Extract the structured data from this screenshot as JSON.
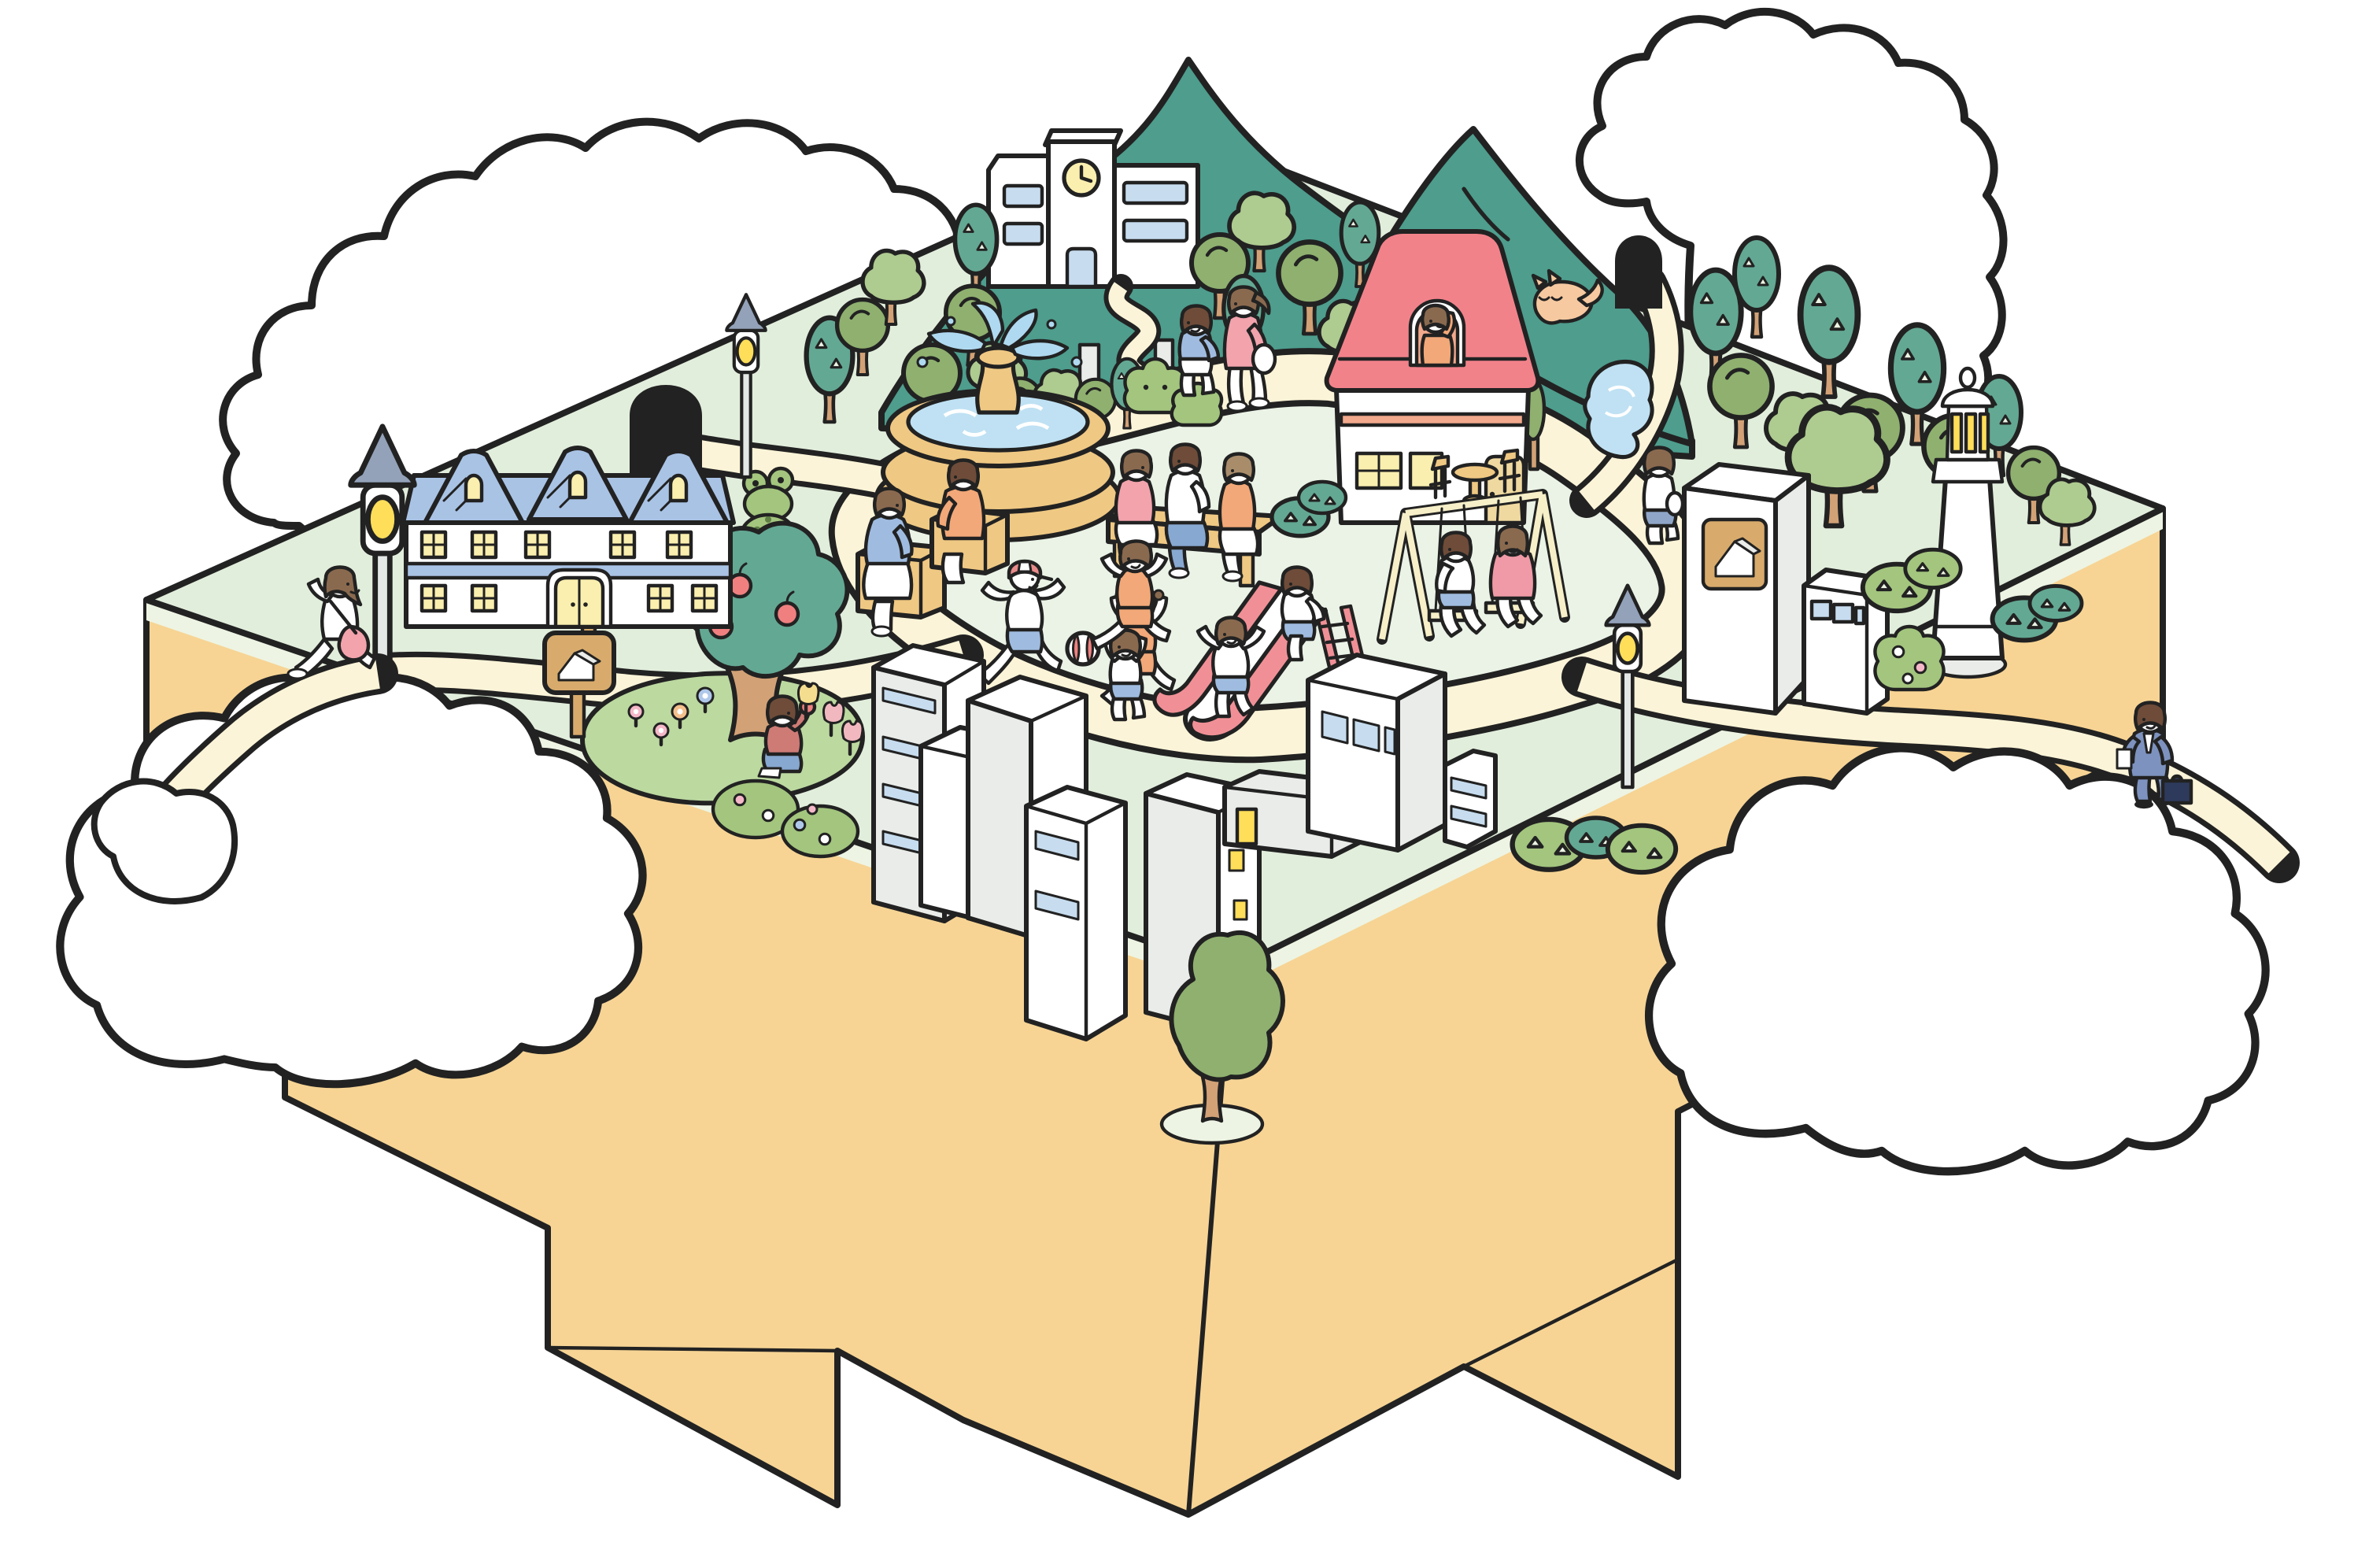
{
  "title": "Cartoon isometric floating-island town with park, houses and playing children",
  "palette": {
    "ink": "#222222",
    "cloud": "#FFFFFF",
    "base": "#F7D494",
    "grass": "#E2EEDC",
    "plaza": "#EAF3E6",
    "band": "#EDF4E3",
    "path": "#FCF4D8",
    "mountain": "#4E9D8D",
    "treeGreen": "#8FB06F",
    "treeLight": "#AECB90",
    "treeTeal": "#63A893",
    "trunk": "#D2A176",
    "bush": "#A3C57E",
    "mound": "#BCD9A0",
    "roofBlue": "#A9C3E5",
    "roofRed": "#F2828A",
    "wall": "#FFFFFF",
    "sideGray": "#E9ECE9",
    "windowYellow": "#FAEFAE",
    "windowBlue": "#C7DDEF",
    "salmon": "#F2A98C",
    "doorTan": "#EFD9A0",
    "fountainTan": "#EFC883",
    "water": "#BFE1F3",
    "spray": "#AFD9F0",
    "slidePink": "#F09096",
    "swingCream": "#F6EFC8",
    "lampPole": "#E4E8E6",
    "lampCap": "#93A2B9",
    "bulbYellow": "#FFDE59",
    "signTan": "#D8AB6C",
    "suitBlue": "#7D92BE",
    "jeansBlue": "#87A8D0",
    "clothPink": "#F2A3AC",
    "clothOrange": "#F2A878",
    "clothBlue": "#9FBCE0",
    "skirtBlue": "#8FA6C9",
    "dressPink": "#EF9AA6",
    "capRed": "#E98B8B",
    "hairDark": "#6E4C39",
    "hairMid": "#8A6A4F",
    "hairLight": "#A98D6B",
    "catOrange": "#F6C9A0",
    "appleRed": "#F08080",
    "flowerPink": "#F4B8C8",
    "flowerBlue": "#AFC8EA",
    "flowerOrange": "#F5C08C",
    "tulipYellow": "#F5DD8F",
    "tulipPink": "#F2B8C0",
    "shirtRust": "#CE7B76"
  },
  "scene": {
    "island": {
      "shape": "isometric block with stepped puzzle-like tan base",
      "surface": "pale green park with looping cream walking path",
      "tunnel_count": 2
    },
    "clouds": [
      {
        "id": "cloud-top-left"
      },
      {
        "id": "cloud-top-right"
      },
      {
        "id": "cloud-left"
      },
      {
        "id": "cloud-bottom-right"
      }
    ],
    "landmarks": [
      {
        "id": "mountain",
        "color_key": "mountain",
        "peaks": 2
      },
      {
        "id": "school",
        "has_clock_tower": true,
        "clock_face": "yellow",
        "window_color_key": "windowBlue"
      },
      {
        "id": "fountain",
        "tiers": 2,
        "water": true,
        "spray": true
      },
      {
        "id": "apartment-house",
        "roof_color_key": "roofBlue",
        "gables": 3,
        "lit_windows": true
      },
      {
        "id": "red-roof-house",
        "roof_color_key": "roofRed",
        "girl_in_attic_window": true
      },
      {
        "id": "lighthouse",
        "lit_lantern_windows": 3
      },
      {
        "id": "store-building",
        "sign_icon": "house-pictogram"
      },
      {
        "id": "small-office-building",
        "window_strip": 3
      },
      {
        "id": "city-buildings",
        "count": 8,
        "window_colors": [
          "windowBlue",
          "windowYellow"
        ]
      },
      {
        "id": "playground-slide",
        "color_key": "slidePink"
      },
      {
        "id": "swing-set",
        "seats": 2,
        "frame_color_key": "swingCream"
      },
      {
        "id": "apple-tree",
        "apples": 3
      },
      {
        "id": "frog-topiary"
      },
      {
        "id": "flower-garden",
        "flowers": [
          "pink",
          "blue",
          "orange",
          "tulips"
        ]
      },
      {
        "id": "pond"
      },
      {
        "id": "notice-sign",
        "icon": "house-pictogram"
      },
      {
        "id": "cafe-table-set",
        "chairs": 2
      },
      {
        "id": "bench-blocks",
        "count": 3
      },
      {
        "id": "street-lamps",
        "count": 3,
        "bulb_color_key": "bulbYellow"
      },
      {
        "id": "tunnels",
        "count": 2,
        "color": "black"
      }
    ],
    "people": [
      {
        "id": "mother-walking",
        "top": "clothPink",
        "bottom": "white",
        "bag": "white"
      },
      {
        "id": "child-walking",
        "top": "clothBlue",
        "bottom": "white"
      },
      {
        "id": "running-girl-left",
        "top": "white",
        "bag": "clothPink"
      },
      {
        "id": "woman-on-block-blue",
        "top": "clothBlue",
        "skirt": "white"
      },
      {
        "id": "woman-on-block-orange",
        "top": "clothOrange",
        "bottom": "white"
      },
      {
        "id": "bench-woman-pink",
        "top": "clothPink",
        "skirt": "white"
      },
      {
        "id": "bench-man",
        "top": "white",
        "bottom": "jeansBlue"
      },
      {
        "id": "bench-woman-orange",
        "top": "clothOrange",
        "bottom": "white"
      },
      {
        "id": "boy-red-cap-with-ball",
        "top": "white",
        "shorts": "clothBlue",
        "cap": "capRed"
      },
      {
        "id": "girl-chasing-ball",
        "top": "clothOrange",
        "bottom": "white"
      },
      {
        "id": "girl-in-attic-window",
        "top": "clothOrange"
      },
      {
        "id": "swing-boy",
        "top": "white",
        "shorts": "clothBlue"
      },
      {
        "id": "swing-girl",
        "dress": "dressPink"
      },
      {
        "id": "boy-top-of-slide",
        "top": "white",
        "shorts": "clothBlue"
      },
      {
        "id": "girl-on-slide",
        "top": "white",
        "shorts": "clothBlue"
      },
      {
        "id": "girl-cheering-at-slide",
        "top": "white",
        "shorts": "clothBlue"
      },
      {
        "id": "running-boy-orange",
        "top": "clothOrange",
        "bottom": "white"
      },
      {
        "id": "walking-kid-right-road",
        "top": "white",
        "skirt": "skirtBlue",
        "bag": "white"
      },
      {
        "id": "businessman",
        "suit": "suitBlue",
        "briefcase": "dark-navy",
        "paper": "white"
      },
      {
        "id": "boy-eating-apple",
        "top": "shirtRust",
        "bottom": "jeansBlue"
      }
    ],
    "animals": [
      {
        "id": "sleeping-cat",
        "color_key": "catOrange"
      }
    ]
  }
}
